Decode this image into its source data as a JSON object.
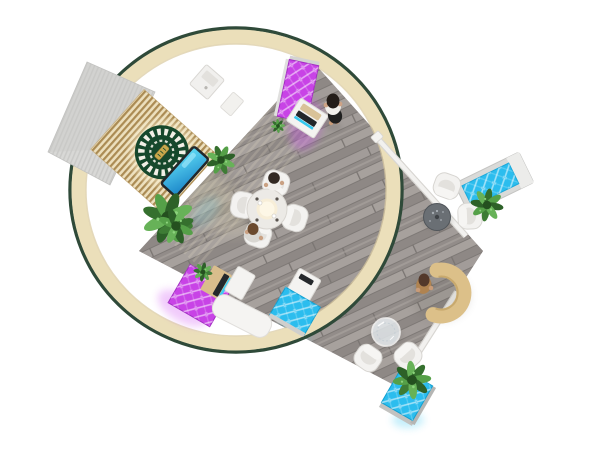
{
  "scene": {
    "background": "#ffffff",
    "ring": {
      "band": "#ebdfba",
      "edge": "#2f4a39",
      "inner_shadow": "#d8c9a0"
    },
    "floor": {
      "base": "#9b9593",
      "seam": "#7d7875"
    },
    "wall": {
      "face": "#ecdfbd",
      "slat": "#ab8b53",
      "shell": "#d8d8d6",
      "logo": "#16482c",
      "logo_trim": "#f2efe6",
      "badge": "#c9a84c",
      "screen_frame": "#23282b"
    },
    "led": {
      "magenta": "#c843e6",
      "magenta_edge": "#a22ec2",
      "cyan": "#2bbdee",
      "cyan_edge": "#129fd0"
    },
    "furniture": {
      "white": "#f4f3f1",
      "tan": "#d9bd8c",
      "desk": "#dcc089",
      "chair": "#f3f2f0",
      "dark_table": "#6a6f74",
      "glass_table": "#e8eef2",
      "round_table": "#eceae6",
      "trim": "#f2f1ef"
    },
    "plants": {
      "core": "#24501f",
      "leaf_dark": "#2d6128",
      "leaf_mid": "#3e7c35",
      "leaf_light": "#55a048"
    },
    "people": {
      "standing_woman": {
        "hair": "#241d19",
        "top": "#f1efec",
        "skirt": "#1f1f1f",
        "skin": "#caa183"
      },
      "receptionist": {
        "hair": "#53382a",
        "top": "#b08350"
      },
      "seated_guest_1": {
        "hair": "#332a24",
        "top": "#f1efec"
      },
      "seated_guest_2": {
        "hair": "#6b4a2e",
        "top": "#d9d7d2"
      }
    },
    "inventory": {
      "chairs": 8,
      "plants": 6,
      "people": 4,
      "kiosks": 5,
      "tables": 4
    }
  }
}
